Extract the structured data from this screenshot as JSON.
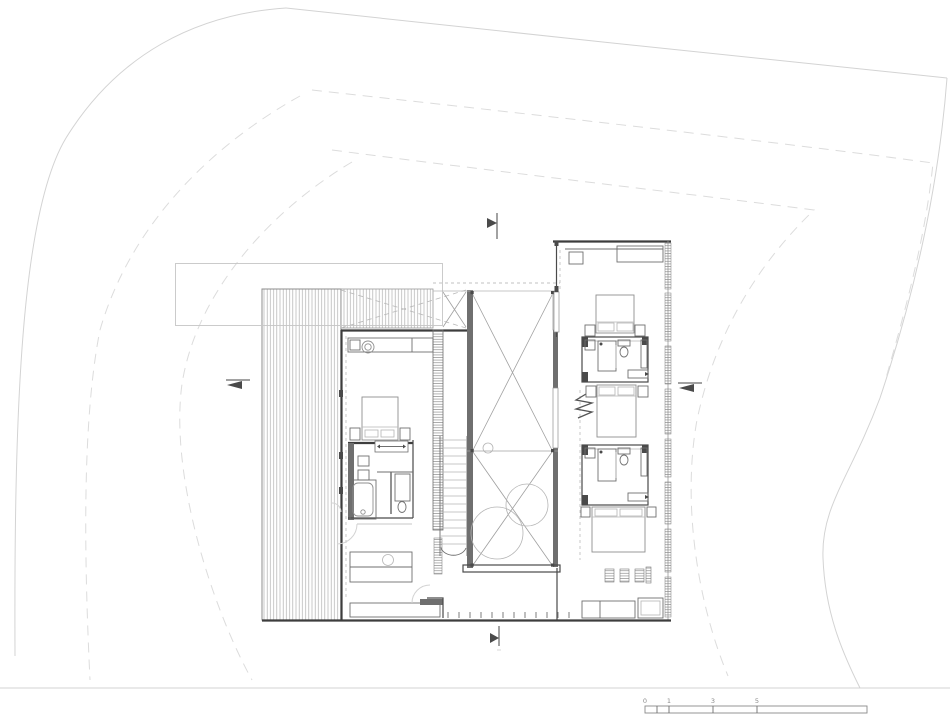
{
  "page": {
    "background": "#ffffff"
  },
  "drawing": {
    "kind": "architectural-floor-plan",
    "level": "upper-floor",
    "scale_bar": {
      "labels": [
        "0",
        "1",
        "3",
        "5"
      ]
    },
    "colors": {
      "wall": "#3d3d3d",
      "fixture": "#6f6f6f",
      "furniture": "#8f8f8f",
      "hatch": "#afafaf",
      "void_line": "#a0a0a0",
      "site_boundary": "#d3d3d3",
      "site_boundary_dashed": "#dcdcdc",
      "label_text": "#8a8a8a",
      "background": "#ffffff"
    },
    "elements": [
      "site-boundary",
      "lower-roof-outline",
      "deck-terrace",
      "master-bedroom",
      "master-bathroom",
      "staircase",
      "central-void",
      "tree-canopies",
      "bedroom-1",
      "bathroom-1",
      "bedroom-2",
      "bathroom-2",
      "bedroom-3",
      "louvre-wall",
      "south-facade-glazing",
      "section-markers",
      "scale-bar"
    ],
    "section_markers": [
      "top",
      "left",
      "right",
      "bottom"
    ]
  }
}
